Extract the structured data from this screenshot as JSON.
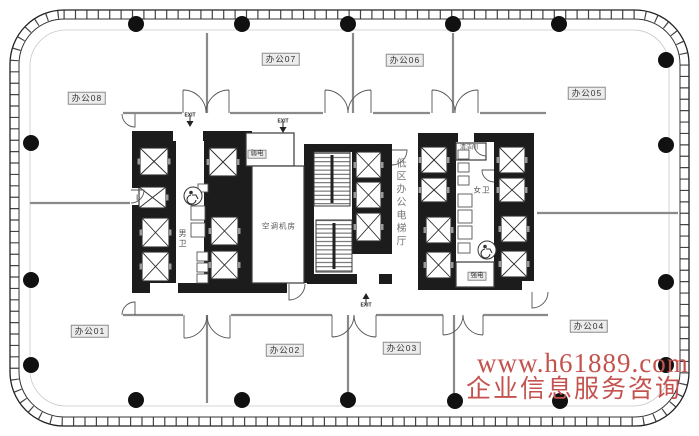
{
  "watermark": {
    "line1": "www.h61889.com",
    "line2": "企业信息服务咨询",
    "color": "#c4534f"
  },
  "labels": {
    "office08": "办公08",
    "office07": "办公07",
    "office06": "办公06",
    "office05": "办公05",
    "office01": "办公01",
    "office02": "办公02",
    "office03": "办公03",
    "office04": "办公04",
    "weak_electric_room": "弱电",
    "strong_electric_room": "强电",
    "ac_machine_room": "空调机房",
    "mens_toilet": "男卫",
    "womens_toilet": "女卫",
    "cleaning_room": "清洁间",
    "elevator_hall": "低区办公电梯厅",
    "exit": "EXIT"
  },
  "colors": {
    "wall_black": "#1c1c1c",
    "partition_gray": "#8a8a8a",
    "line_dark": "#2a2a2a",
    "fixture_gray": "#555555"
  },
  "floorplan": {
    "columns": [
      [
        136,
        24
      ],
      [
        242,
        24
      ],
      [
        348,
        24
      ],
      [
        453,
        24
      ],
      [
        559,
        24
      ],
      [
        136,
        400
      ],
      [
        242,
        400
      ],
      [
        348,
        400
      ],
      [
        455,
        401
      ],
      [
        560,
        401
      ],
      [
        31,
        143
      ],
      [
        31,
        280
      ],
      [
        31,
        365
      ],
      [
        666,
        60
      ],
      [
        666,
        145
      ],
      [
        666,
        282
      ],
      [
        666,
        365
      ]
    ],
    "walls": [
      [
        132,
        131,
        44,
        162
      ],
      [
        204,
        131,
        48,
        162
      ],
      [
        176,
        131,
        28,
        10
      ],
      [
        176,
        283,
        28,
        10
      ],
      [
        304,
        144,
        10,
        140
      ],
      [
        352,
        144,
        40,
        110
      ],
      [
        314,
        144,
        38,
        8
      ],
      [
        314,
        274,
        78,
        10
      ],
      [
        252,
        283,
        52,
        10
      ],
      [
        418,
        133,
        38,
        157
      ],
      [
        494,
        133,
        40,
        157
      ],
      [
        456,
        133,
        38,
        9
      ],
      [
        456,
        281,
        38,
        9
      ]
    ],
    "openings": [
      [
        173,
        131,
        30,
        10
      ],
      [
        132,
        188,
        12,
        17
      ],
      [
        150,
        283,
        28,
        10
      ],
      [
        357,
        274,
        22,
        10
      ],
      [
        287,
        283,
        20,
        10
      ],
      [
        458,
        133,
        16,
        9
      ],
      [
        522,
        281,
        12,
        9
      ]
    ],
    "rooms": [
      [
        246,
        133,
        48,
        33
      ],
      [
        252,
        166,
        52,
        117
      ],
      [
        456,
        143,
        30,
        17
      ],
      [
        456,
        262,
        38,
        25
      ]
    ],
    "stairs": [
      [
        314,
        152,
        36,
        54
      ],
      [
        316,
        220,
        36,
        52
      ]
    ],
    "elevators": [
      [
        140,
        148,
        28,
        27
      ],
      [
        139,
        187,
        27,
        21
      ],
      [
        142,
        218,
        27,
        29
      ],
      [
        142,
        252,
        27,
        29
      ],
      [
        209,
        148,
        28,
        28
      ],
      [
        211,
        217,
        27,
        28
      ],
      [
        211,
        251,
        27,
        28
      ],
      [
        356,
        152,
        25,
        26
      ],
      [
        356,
        182,
        25,
        26
      ],
      [
        356,
        213,
        25,
        28
      ],
      [
        421,
        147,
        26,
        26
      ],
      [
        421,
        178,
        26,
        24
      ],
      [
        426,
        217,
        25,
        26
      ],
      [
        426,
        252,
        25,
        26
      ],
      [
        499,
        147,
        26,
        26
      ],
      [
        499,
        178,
        26,
        24
      ],
      [
        501,
        216,
        26,
        26
      ],
      [
        501,
        251,
        26,
        26
      ]
    ],
    "fixtures": [
      [
        191,
        206,
        14,
        14
      ],
      [
        191,
        223,
        14,
        14
      ],
      [
        197,
        252,
        11,
        9
      ],
      [
        197,
        263,
        11,
        9
      ],
      [
        197,
        274,
        11,
        9
      ],
      [
        198,
        184,
        10,
        8
      ],
      [
        458,
        150,
        11,
        9
      ],
      [
        458,
        163,
        11,
        9
      ],
      [
        458,
        176,
        11,
        9
      ],
      [
        458,
        194,
        14,
        13
      ],
      [
        458,
        210,
        14,
        13
      ],
      [
        458,
        226,
        14,
        13
      ],
      [
        458,
        243,
        12,
        10
      ]
    ],
    "wheelchairs": [
      [
        193,
        196
      ],
      [
        487,
        250
      ]
    ],
    "partitions": [
      [
        123,
        113,
        182,
        113
      ],
      [
        230,
        113,
        323,
        113
      ],
      [
        373,
        113,
        430,
        113
      ],
      [
        480,
        113,
        546,
        113
      ],
      [
        123,
        315,
        183,
        315
      ],
      [
        231,
        315,
        332,
        315
      ],
      [
        376,
        315,
        443,
        315
      ],
      [
        483,
        315,
        548,
        315
      ],
      [
        207,
        33,
        207,
        113
      ],
      [
        353,
        33,
        353,
        113
      ],
      [
        453,
        33,
        453,
        113
      ],
      [
        207,
        315,
        207,
        403
      ],
      [
        348,
        315,
        348,
        403
      ],
      [
        454,
        315,
        454,
        403
      ],
      [
        30,
        203,
        130,
        203
      ],
      [
        537,
        213,
        678,
        213
      ]
    ],
    "double_doors": [
      [
        206,
        113,
        46,
        -1
      ],
      [
        348,
        113,
        46,
        -1
      ],
      [
        455,
        113,
        46,
        -1
      ],
      [
        207,
        315,
        46,
        1
      ],
      [
        354,
        315,
        44,
        1
      ],
      [
        463,
        315,
        40,
        1
      ]
    ],
    "single_doors": [
      "M135,114 L135,127 A13,13 0 0 1 122,114",
      "M135,315 L135,302 A13,13 0 0 0 122,315",
      "M131,190 L144,190 A13,13 0 0 1 131,203",
      "M289,284 L289,300 A16,16 0 0 0 305,284",
      "M532,292 L532,308 A16,16 0 0 0 548,292",
      "M392,150 L407,150 A15,15 0 0 1 392,165",
      "M486,144 L486,156 A12,12 0 0 1 474,144",
      "M494,170 L482,170 A12,12 0 0 0 494,182"
    ],
    "exit_arrows": [
      [
        190,
        121,
        1
      ],
      [
        283,
        127,
        1
      ],
      [
        366,
        299,
        -1
      ]
    ]
  }
}
